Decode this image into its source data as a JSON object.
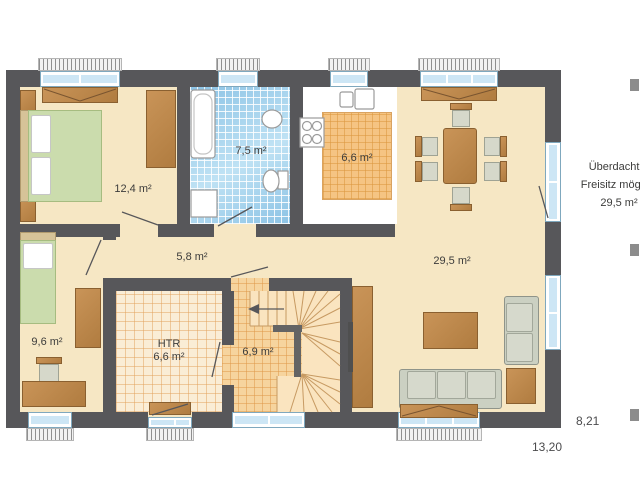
{
  "rooms": {
    "bedroom": {
      "area": "12,4 m²"
    },
    "bath": {
      "area": "7,5 m²"
    },
    "kitchen": {
      "area": "6,6 m²"
    },
    "living": {
      "area": "29,5 m²"
    },
    "hall": {
      "area": "5,8 m²"
    },
    "child": {
      "area": "9,6 m²"
    },
    "htr": {
      "label": "HTR",
      "area": "6,6 m²"
    },
    "stair": {
      "area": "6,9 m²"
    }
  },
  "note": {
    "line1": "Überdachter",
    "line2": "Freisitz möglich",
    "line3": "29,5 m²"
  },
  "dimensions": {
    "right": "8,21",
    "bottom": "13,20"
  },
  "colors": {
    "wall": "#57575A",
    "floor": "#F6E7C4",
    "furniture": "#BE8A4E",
    "bath_tile": "#A6D3EE",
    "kitchen_tile": "#F5C483",
    "window_glass": "#CDE6F5",
    "bed_green": "#CBDCAD",
    "sofa": "#CBD0C2"
  }
}
